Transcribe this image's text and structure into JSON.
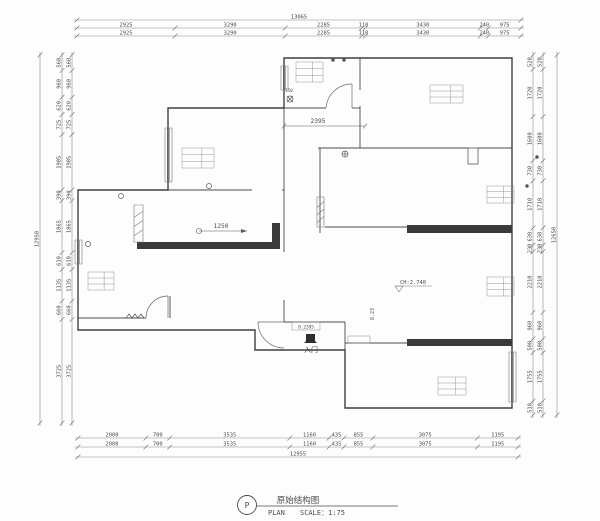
{
  "drawing": {
    "dimensions": {
      "top": {
        "total": "13065",
        "row1": [
          "2925",
          "3290",
          "2285",
          "110",
          "3430",
          "240",
          "975"
        ],
        "row2": [
          "2925",
          "3290",
          "2285",
          "110",
          "3430",
          "240",
          "975"
        ]
      },
      "bottom": {
        "total": "12955",
        "row1": [
          "2000",
          "700",
          "3535",
          "1160",
          "435",
          "855",
          "3075",
          "1195"
        ],
        "row2": [
          "2000",
          "700",
          "3535",
          "1160",
          "435",
          "855",
          "3075",
          "1195"
        ]
      },
      "left": {
        "total": "12950",
        "row1": [
          "560",
          "960",
          "620",
          "725",
          "1985",
          "390",
          "1865",
          "610",
          "1135",
          "660",
          "3725"
        ],
        "row2": [
          "560",
          "960",
          "620",
          "725",
          "1985",
          "390",
          "1865",
          "610",
          "1135",
          "660",
          "3725"
        ]
      },
      "right": {
        "total": "12650",
        "row1": [
          "520",
          "1720",
          "1600",
          "730",
          "1710",
          "630",
          "230",
          "2210",
          "960",
          "500",
          "1755",
          "510"
        ],
        "row2": [
          "520",
          "1720",
          "1600",
          "730",
          "1710",
          "630",
          "230",
          "2210",
          "960",
          "500",
          "1755",
          "510"
        ]
      }
    },
    "inner_dims": {
      "hall_width": "2395",
      "living_offset": "1250"
    },
    "labels": {
      "entry": "入门",
      "level": "8.23",
      "sill": "0.2395",
      "ceiling_height": "CH:2.740",
      "vent": "150"
    },
    "title_block": {
      "symbol": "P",
      "title": "原始结构图",
      "plan": "PLAN",
      "scale": "SCALE：1:75"
    }
  }
}
